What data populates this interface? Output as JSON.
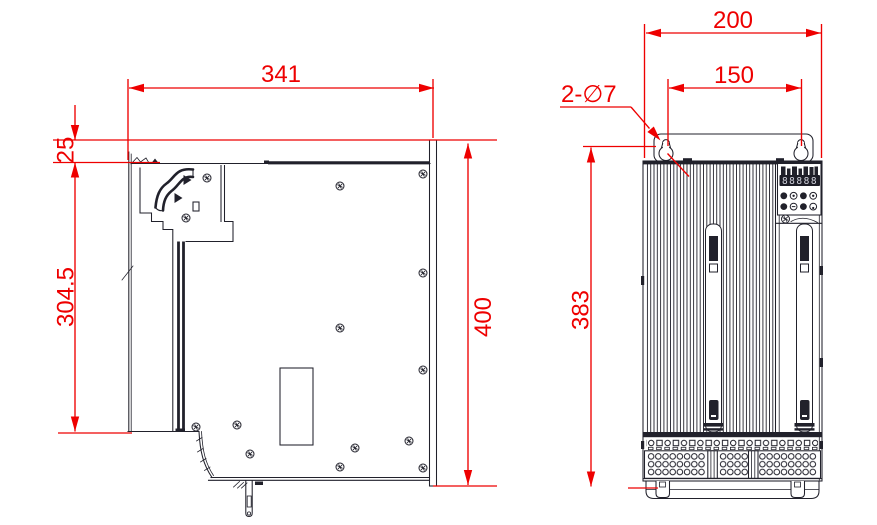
{
  "drawing": {
    "description": "Mechanical dimension drawing with two orthographic views of a servo drive unit",
    "units": "mm",
    "colors": {
      "dimension": "#ee0000",
      "line": "#21212b",
      "background": "#ffffff"
    }
  },
  "side_view": {
    "dimensions": {
      "depth": {
        "label": "341",
        "value": 341
      },
      "flange_offset": {
        "label": "25",
        "value": 25
      },
      "body_height": {
        "label": "304.5",
        "value": 304.5
      },
      "overall_height": {
        "label": "400",
        "value": 400
      }
    }
  },
  "front_view": {
    "dimensions": {
      "overall_width": {
        "label": "200",
        "value": 200
      },
      "hole_spacing": {
        "label": "150",
        "value": 150
      },
      "mounting_height": {
        "label": "383",
        "value": 383
      }
    },
    "callouts": {
      "mounting_holes": {
        "label": "2-∅7",
        "count": 2,
        "diameter": 7
      }
    },
    "keypad": {
      "display_value": "88888"
    }
  }
}
